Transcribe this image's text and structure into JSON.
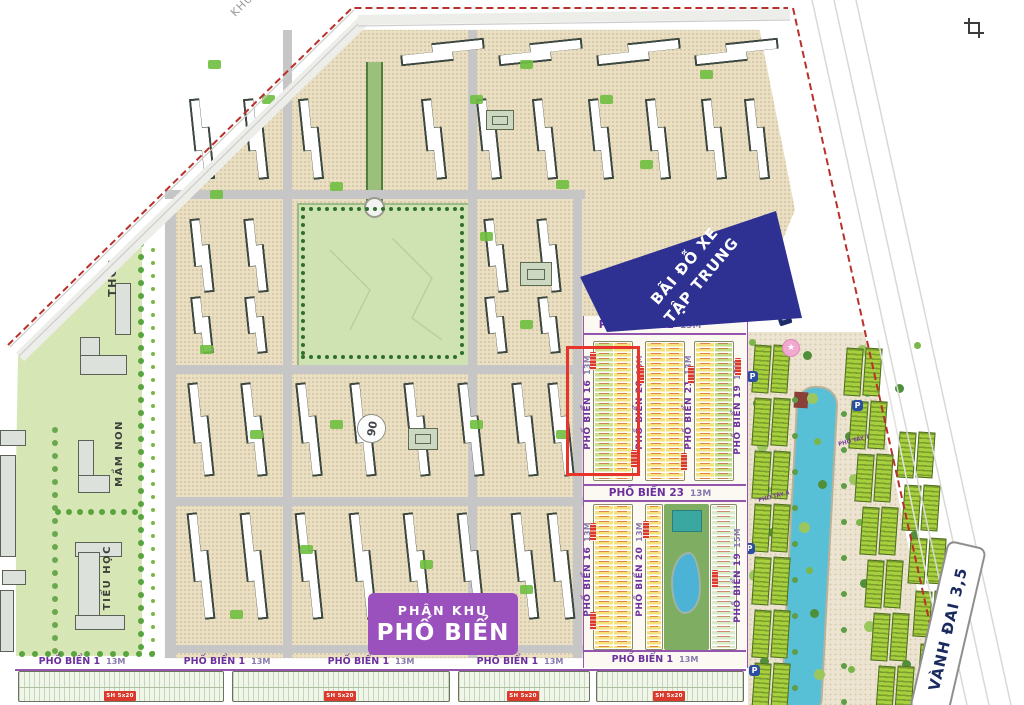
{
  "overlay": {
    "corner_text": "KHU D"
  },
  "colors": {
    "boundary": "#b8312a",
    "banner_bg": "#2e3192",
    "zone_bg": "#9b51bd",
    "street_text": "#6b2f9e",
    "lot_yellow": "#f6e27d",
    "lot_green": "#c3dc85",
    "lot_mint": "#d9ecca",
    "canal": "#58c0d6",
    "highlight": "#e8342a"
  },
  "schools": {
    "thcs": "THCS",
    "mam_non": "MẦM NON",
    "tieu_hoc": "TIỂU HỌC"
  },
  "badges": {
    "block_number": "06"
  },
  "parking_banner": {
    "line1": "BÃI ĐỖ XE",
    "line2": "TẬP TRUNG"
  },
  "zone_box": {
    "line1": "PHÂN KHU",
    "line2": "PHỐ BIỂN"
  },
  "ring_road": {
    "label": "VÀNH ĐAI 3,5"
  },
  "streets": {
    "top": {
      "name": "PHỐ BIỂN 22",
      "w": "13M"
    },
    "mid": {
      "name": "PHỐ BIỂN 23",
      "w": "13M"
    },
    "v_upper": [
      {
        "name": "PHỐ BIỂN 16",
        "w": "13M"
      },
      {
        "name": "PHỐ BIỂN 20",
        "w": "13M"
      },
      {
        "name": "PHỐ BIỂN 21",
        "w": "13M"
      },
      {
        "name": "PHỐ BIỂN 19",
        "w": "15M"
      }
    ],
    "v_lower": [
      {
        "name": "PHỐ BIỂN 16",
        "w": "13M"
      },
      {
        "name": "PHỐ BIỂN 20",
        "w": "13M"
      },
      {
        "name": "PHỐ BIỂN 19",
        "w": "15M"
      }
    ],
    "bottom": [
      {
        "name": "PHỐ BIỂN 1",
        "w": "13M"
      },
      {
        "name": "PHỐ BIỂN 1",
        "w": "13M"
      },
      {
        "name": "PHỐ BIỂN 1",
        "w": "13M"
      },
      {
        "name": "PHỐ BIỂN 1",
        "w": "13M"
      },
      {
        "name": "PHỐ BIỂN 1",
        "w": "13M"
      }
    ],
    "west": [
      {
        "name": "PHỐ TÂY 6"
      },
      {
        "name": "PHỐ TÂY 7"
      }
    ]
  },
  "tags": {
    "lot_size": "SH 5x20"
  },
  "map_icons": {
    "parking": "P",
    "star": "★"
  }
}
